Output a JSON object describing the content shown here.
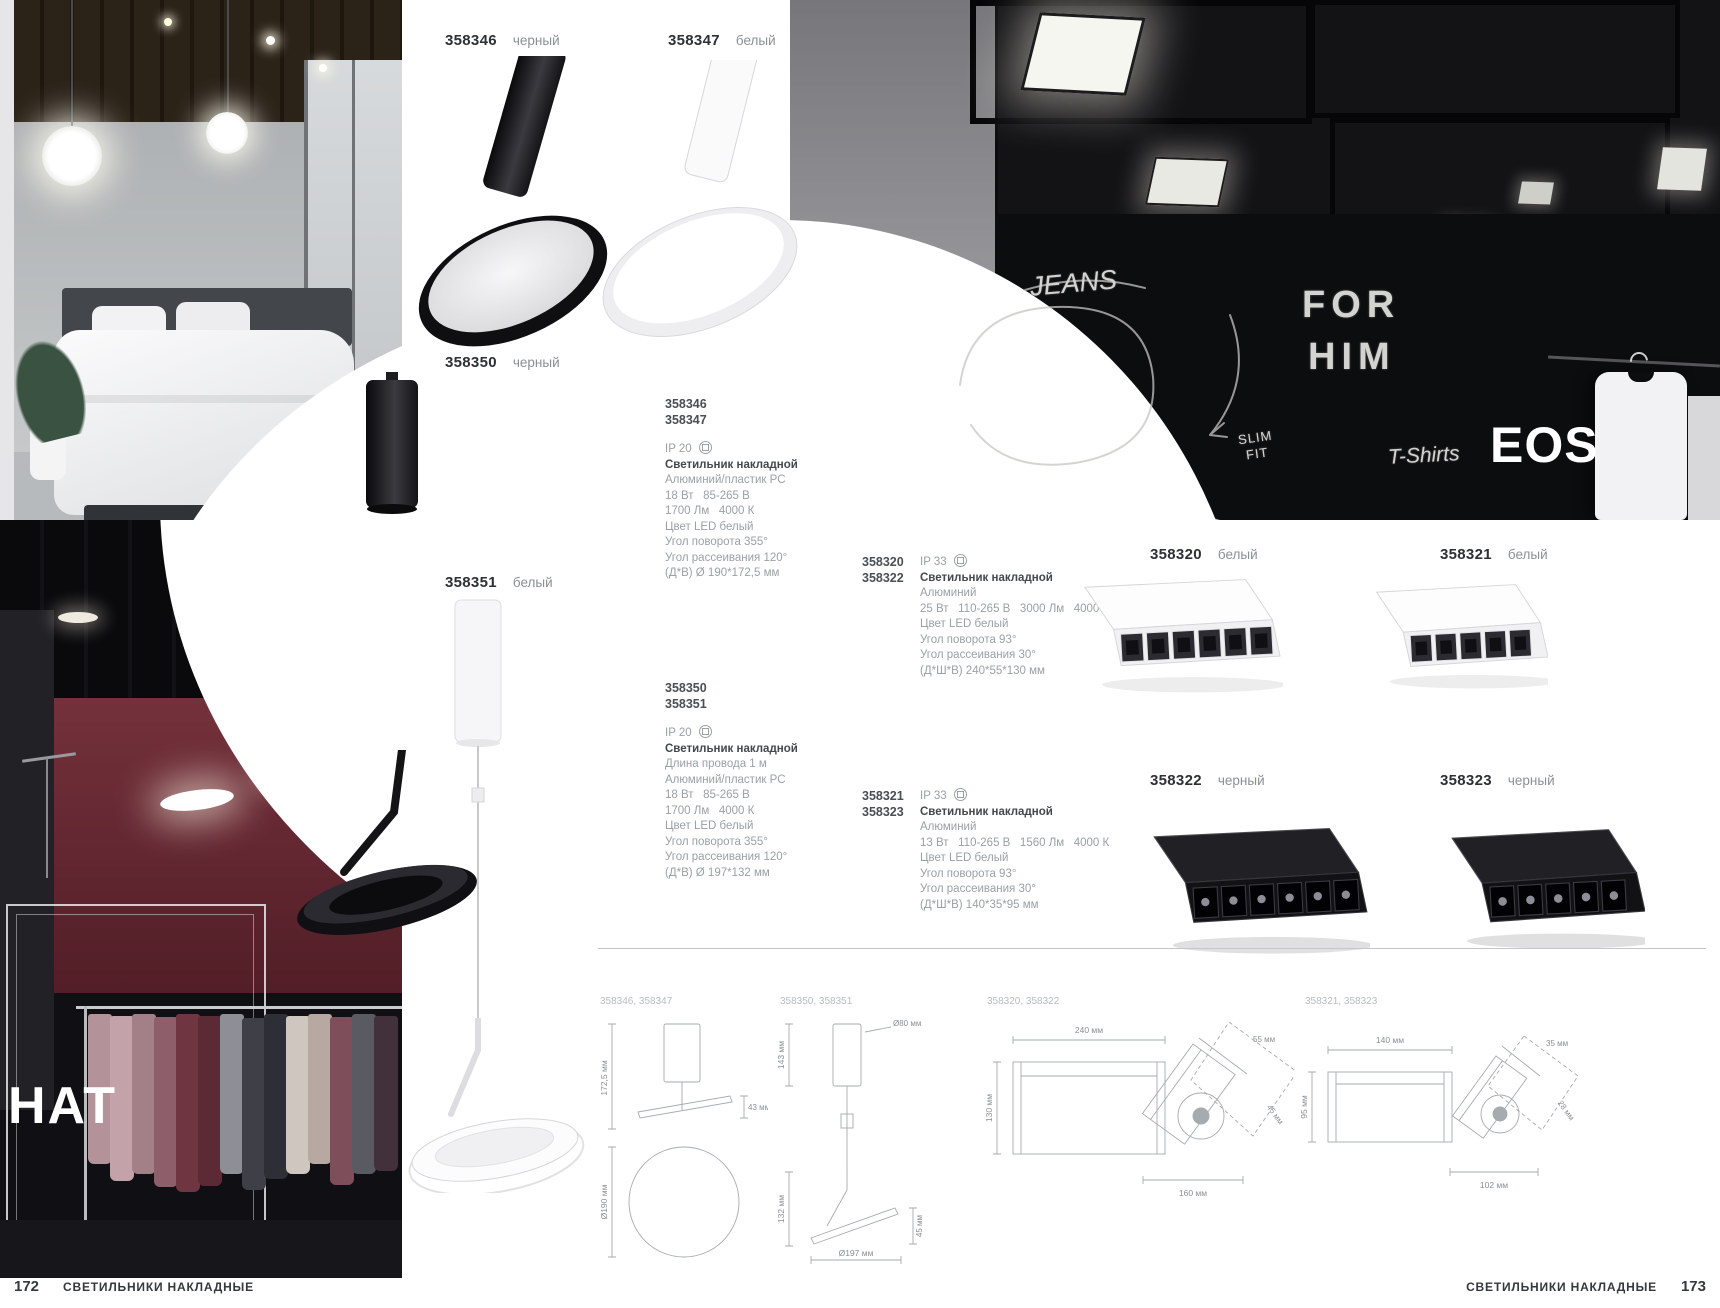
{
  "brand": {
    "left_series": "HAT",
    "right_series": "EOS"
  },
  "chalk": {
    "jeans": "JEANS",
    "for_line": "FOR",
    "him_line": "HIM",
    "slim": "SLIM",
    "fit": "FIT",
    "tshirts": "T-Shirts"
  },
  "product_labels": [
    {
      "code": "358346",
      "color": "черный"
    },
    {
      "code": "358347",
      "color": "белый"
    },
    {
      "code": "358350",
      "color": "черный"
    },
    {
      "code": "358351",
      "color": "белый"
    },
    {
      "code": "358320",
      "color": "белый"
    },
    {
      "code": "358321",
      "color": "белый"
    },
    {
      "code": "358322",
      "color": "черный"
    },
    {
      "code": "358323",
      "color": "черный"
    }
  ],
  "spec_blocks": [
    {
      "code1": "358346",
      "code2": "358347",
      "ip": "IP 20",
      "title": "Светильник накладной",
      "lines": [
        "Алюминий/пластик PC",
        "18 Вт   85-265 В",
        "1700 Лм   4000 К",
        "Цвет LED белый",
        "Угол поворота 355°",
        "Угол рассеивания 120°",
        "(Д*В) Ø 190*172,5 мм"
      ]
    },
    {
      "code1": "358350",
      "code2": "358351",
      "ip": "IP 20",
      "title": "Светильник накладной",
      "lines": [
        "Длина провода 1 м",
        "Алюминий/пластик PC",
        "18 Вт   85-265 В",
        "1700 Лм   4000 К",
        "Цвет LED белый",
        "Угол поворота 355°",
        "Угол рассеивания 120°",
        "(Д*В) Ø 197*132 мм"
      ]
    },
    {
      "code1": "358320",
      "code2": "358322",
      "ip": "IP 33",
      "title": "Светильник накладной",
      "lines": [
        "Алюминий",
        "25 Вт   110-265 В   3000 Лм   4000 К",
        "Цвет LED белый",
        "Угол поворота 93°",
        "Угол рассеивания 30°",
        "(Д*Ш*В) 240*55*130 мм"
      ]
    },
    {
      "code1": "358321",
      "code2": "358323",
      "ip": "IP 33",
      "title": "Светильник накладной",
      "lines": [
        "Алюминий",
        "13 Вт   110-265 В   1560 Лм   4000 К",
        "Цвет LED белый",
        "Угол поворота 93°",
        "Угол рассеивания 30°",
        "(Д*Ш*В) 140*35*95 мм"
      ]
    }
  ],
  "diagrams": [
    {
      "label": "358346, 358347",
      "dim_height": "172,5 мм",
      "dim_offset": "43 мм",
      "dim_diameter": "Ø190 мм"
    },
    {
      "label": "358350, 358351",
      "dim_top": "143 мм",
      "dim_dia_top": "Ø80 мм",
      "dim_height": "132 мм",
      "dim_side": "45 мм",
      "dim_dia_bottom": "Ø197 мм"
    },
    {
      "label": "358320, 358322",
      "dim_width": "240 мм",
      "dim_height": "130 мм",
      "dim_top": "55 мм",
      "dim_side": "45 мм",
      "dim_bottom": "160 мм"
    },
    {
      "label": "358321, 358323",
      "dim_width": "140 мм",
      "dim_height": "95 мм",
      "dim_top": "35 мм",
      "dim_side": "28 мм",
      "dim_bottom": "102 мм"
    }
  ],
  "footer": {
    "left_page": "172",
    "right_page": "173",
    "left_label": "СВЕТИЛЬНИКИ НАКЛАДНЫЕ",
    "right_label": "СВЕТИЛЬНИКИ НАКЛАДНЫЕ"
  }
}
